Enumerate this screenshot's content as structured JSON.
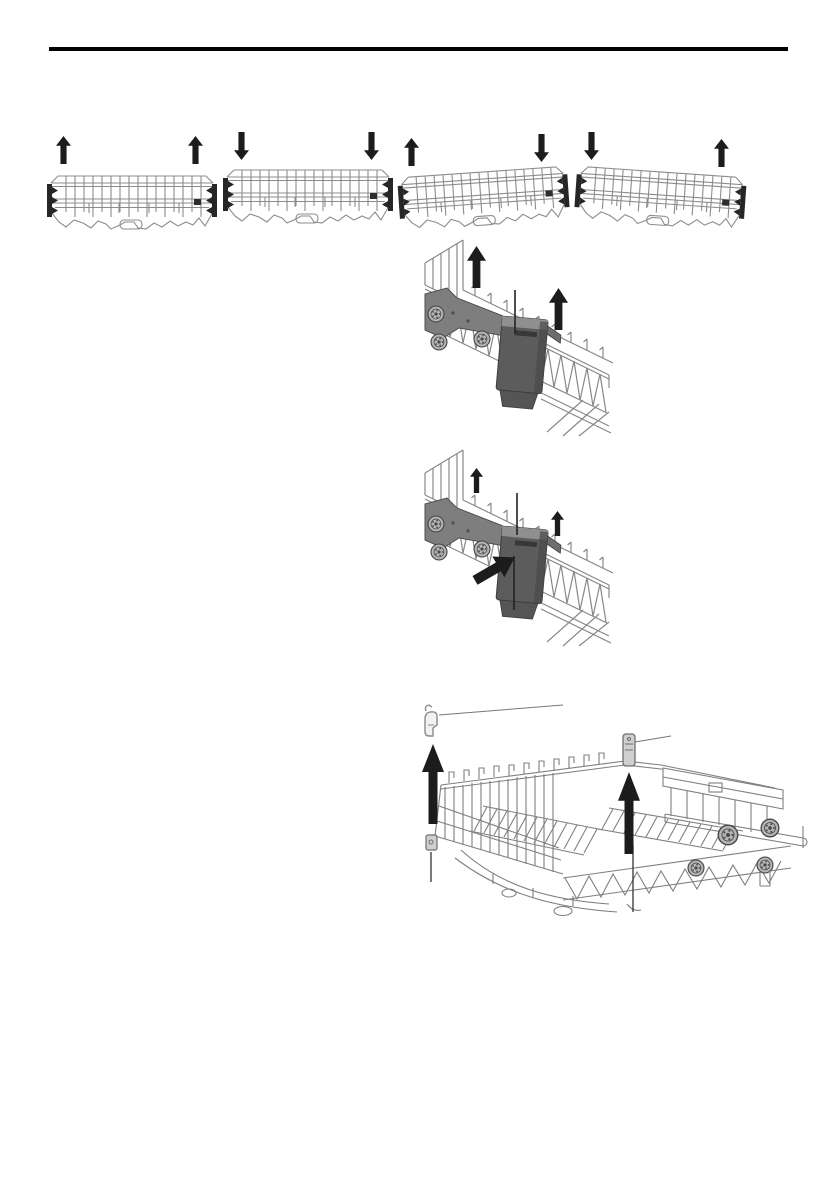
{
  "document": {
    "kind": "appliance manual page (illustrations only)",
    "visible_text": "",
    "page_background": "#ffffff"
  },
  "header": {
    "rule_color": "#000000"
  },
  "colors": {
    "arrow": "#1c1c1c",
    "wire_light": "#8c8c8c",
    "wire_medium": "#7f7f7f",
    "clip_dark": "#262626",
    "plate_gray": "#7e7e7e",
    "plate_edge": "#4f4f4f",
    "latch_gray": "#5c5c5c",
    "latch_ridge": "#8f8f8f",
    "callout": "#333333",
    "callout_thin": "#777777",
    "clip_fill": "#cfcfcf"
  },
  "figures": [
    {
      "id": "upper-basket-raise-level",
      "arrows": [
        "up-arrow",
        "up-arrow"
      ],
      "subject": "upper basket front view, both sides raised"
    },
    {
      "id": "upper-basket-lower-level",
      "arrows": [
        "down-arrow",
        "down-arrow"
      ],
      "subject": "upper basket front view, both sides lowered"
    },
    {
      "id": "upper-basket-tilt-right-high",
      "arrows": [
        "up-arrow",
        "down-arrow"
      ],
      "subject": "upper basket tilted, right side high"
    },
    {
      "id": "upper-basket-tilt-left-high",
      "arrows": [
        "down-arrow",
        "up-arrow"
      ],
      "subject": "upper basket tilted, left side high"
    },
    {
      "id": "basket-side-rail-lift",
      "arrows": [
        "up-arrow",
        "up-arrow"
      ],
      "callout_lines": 1,
      "subject": "basket side rail with rollers and latch, lift upward"
    },
    {
      "id": "basket-side-rail-latch-press",
      "arrows": [
        "up-arrow",
        "up-arrow",
        "press-arrow"
      ],
      "callout_lines": 2,
      "subject": "basket side rail, press latch while lifting"
    },
    {
      "id": "lower-basket-clip-removal",
      "arrows": [
        "up-arrow",
        "up-arrow"
      ],
      "callout_lines": 4,
      "subject": "lower basket with two retaining clips pulled upward"
    }
  ]
}
